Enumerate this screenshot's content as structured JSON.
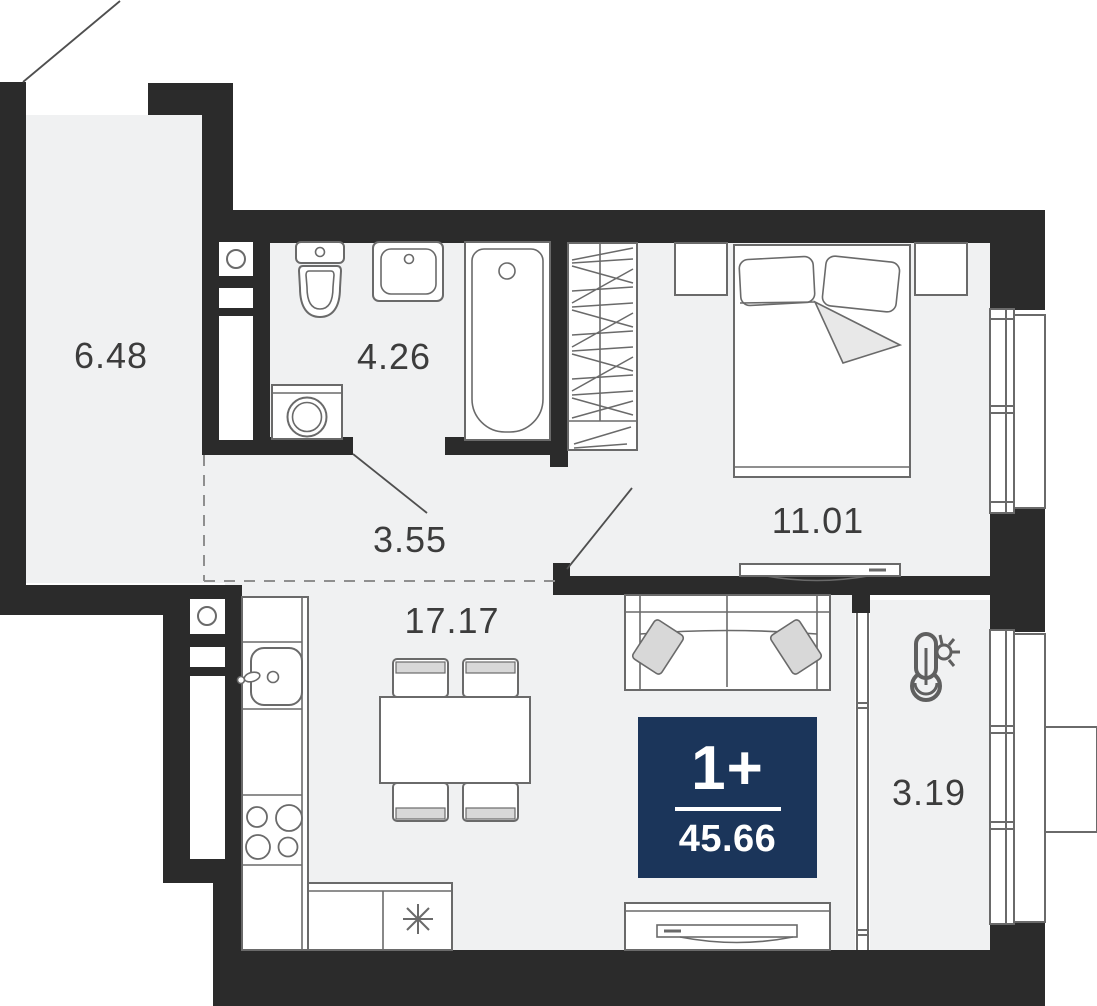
{
  "floor_plan": {
    "unit_badge": {
      "rooms": "1+",
      "total_area": "45.66"
    },
    "areas": {
      "hallway": "6.48",
      "bathroom": "4.26",
      "corridor": "3.55",
      "kitchen_living": "17.17",
      "bedroom": "11.01",
      "balcony": "3.19"
    },
    "colors": {
      "wall": "#2b2b2b",
      "floor": "#f0f1f2",
      "outline": "#6a6a6a",
      "badge_bg": "#1b355a",
      "badge_text": "#ffffff",
      "label_text": "#3c3c3c",
      "soft_fill": "#d8d8d8",
      "blanket_fold": "#e8e8e8"
    },
    "icons": [
      "entry-door-swing-icon",
      "toilet-icon",
      "bathroom-sink-icon",
      "bathtub-icon",
      "washing-machine-icon",
      "ventilation-shaft-icon",
      "wardrobe-icon",
      "nightstand-icon",
      "double-bed-icon",
      "tv-console-icon",
      "sofa-icon",
      "dining-table-icon",
      "stool-icon",
      "kitchen-sink-icon",
      "stove-hob-icon",
      "hob-asterisk-icon",
      "thermometer-sun-icon",
      "window-icon"
    ]
  }
}
